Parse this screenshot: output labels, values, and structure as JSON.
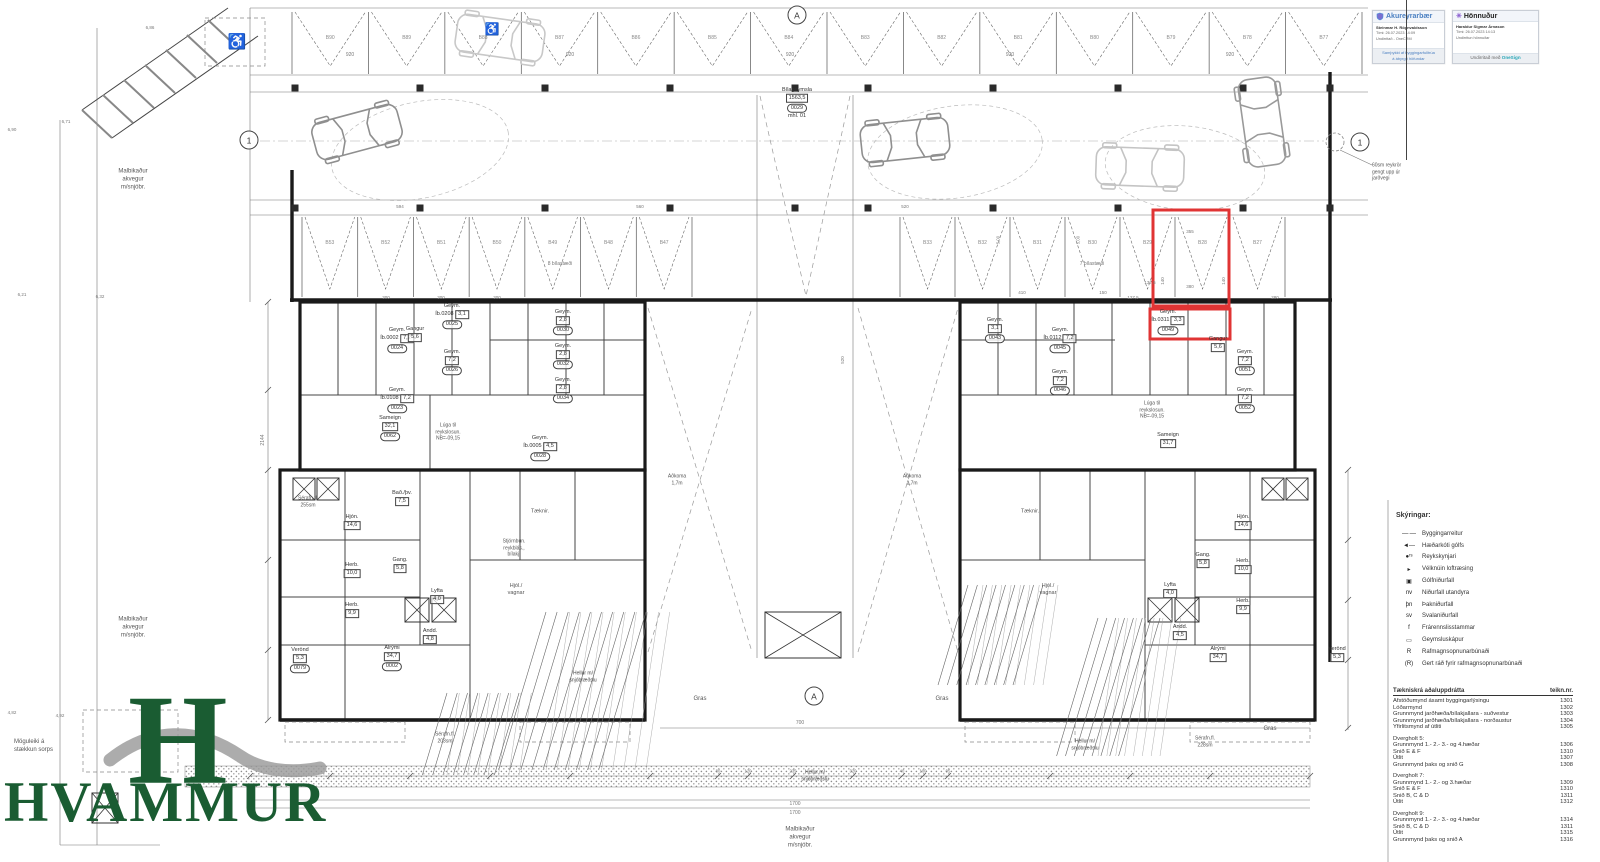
{
  "colors": {
    "highlight": "#e03434",
    "logo_green": "#1a5c32",
    "stamp_blue": "#4a7fc1",
    "onesign_teal": "#2aa7b8",
    "line_dark": "#333333"
  },
  "logo": {
    "mark": "H",
    "name": "HVAMMUR"
  },
  "stamps": {
    "municipality": {
      "header": "Akureyrarbær",
      "name": "Steinmar H. Rögnvaldsson",
      "time": "Tími: 26.07.2023 14:09",
      "sub": "Undirritað - OneCRM",
      "footer_line1": "Samþykkt af byggingarfulltrúa",
      "footer_line2": "á ábyrgð höfundar"
    },
    "designer": {
      "header": "Hönnuður",
      "icon": "✳",
      "name": "Haraldur Sigmar Árnason",
      "time": "Tími: 26.07.2023 14:13",
      "sub": "Undirritun hönnuðar",
      "footer_prefix": "Undirritað með ",
      "footer_brand": "OneSign"
    }
  },
  "legend": {
    "title": "Skýringar:",
    "items": [
      {
        "sym": "—·—",
        "label": "Byggingarreitur"
      },
      {
        "sym": "◄—",
        "label": "Hæðarkóti gólfs"
      },
      {
        "sym": "●ʳˢ",
        "label": "Reykskynjari"
      },
      {
        "sym": "▸",
        "label": "Vélknúin loftræsing"
      },
      {
        "sym": "▣",
        "label": "Gólfniðurfall"
      },
      {
        "sym": "nv",
        "label": "Niðurfall utandyra"
      },
      {
        "sym": "þn",
        "label": "Þakniðurfall"
      },
      {
        "sym": "sv",
        "label": "Svalaniðurfall"
      },
      {
        "sym": "f",
        "label": "Frárennslisstammar"
      },
      {
        "sym": "▭",
        "label": "Geymsluskápur"
      },
      {
        "sym": "R",
        "label": "Rafmagnsopnunarbúnaði"
      },
      {
        "sym": "(R)",
        "label": "Gert ráð fyrir rafmagnsopnunarbúnaði"
      }
    ]
  },
  "drawing_list": {
    "title": "Tækniskrá aðaluppdrátta",
    "col": "teikn.nr.",
    "sections": [
      {
        "rows": [
          [
            "Afstöðumynd ásamt byggingarlýsingu",
            "1301"
          ],
          [
            "Lóðarmynd",
            "1302"
          ],
          [
            "Grunnmynd jarðhæða/bílakjallara - suðvestur",
            "1303"
          ],
          [
            "Grunnmynd jarðhæða/bílakjallara - norðaustur",
            "1304"
          ],
          [
            "Yfirlitsmynd af útliti",
            "1305"
          ]
        ]
      },
      {
        "title": "Dvergholt 5:",
        "rows": [
          [
            "Grunnmynd 1.- 2.- 3.- og 4.hæðar",
            "1306"
          ],
          [
            "Snið E & F",
            "1310"
          ],
          [
            "Útlit",
            "1307"
          ],
          [
            "Grunnmynd þaks og snið G",
            "1308"
          ]
        ]
      },
      {
        "title": "Dvergholt 7:",
        "rows": [
          [
            "Grunnmynd 1.- 2.- og 3.hæðar",
            "1309"
          ],
          [
            "Snið E & F",
            "1310"
          ],
          [
            "Snið B, C & D",
            "1311"
          ],
          [
            "Útlit",
            "1312"
          ]
        ]
      },
      {
        "title": "Dvergholt 9:",
        "rows": [
          [
            "Grunnmynd 1.- 2.- 3.- og 4.hæðar",
            "1314"
          ],
          [
            "Snið B, C & D",
            "1311"
          ],
          [
            "Útlit",
            "1315"
          ],
          [
            "Grunnmynd þaks og snið A",
            "1316"
          ]
        ]
      }
    ]
  },
  "plan": {
    "markers": [
      {
        "t": "A",
        "x": 797,
        "y": 15
      },
      {
        "t": "A",
        "x": 814,
        "y": 696
      },
      {
        "t": "1",
        "x": 249,
        "y": 140
      },
      {
        "t": "1",
        "x": 1360,
        "y": 142
      }
    ],
    "parking": {
      "rows": [
        {
          "x0": 292,
          "x1": 1362,
          "y0": 12,
          "y1": 70,
          "labels": [
            "B90",
            "B89",
            "B88",
            "B87",
            "B86",
            "B85",
            "B84",
            "B83",
            "B82",
            "B81",
            "B80",
            "B79",
            "B78",
            "B77"
          ]
        },
        {
          "x0": 302,
          "x1": 692,
          "y0": 217,
          "y1": 293,
          "labels": [
            "B53",
            "B52",
            "B51",
            "B50",
            "B49",
            "B48",
            "B47"
          ]
        },
        {
          "x0": 900,
          "x1": 1285,
          "y0": 217,
          "y1": 293,
          "labels": [
            "B33",
            "B32",
            "B31",
            "B30",
            "B29",
            "B28",
            "B27"
          ]
        }
      ]
    },
    "rooms": [
      {
        "lines": [
          "Bílageymsla",
          "1563,5"
        ],
        "tag": "0029",
        "extra": "mhl. 01",
        "x": 797,
        "y": 103
      },
      {
        "lines": [
          "Geym.",
          "Íb.0002  7,2"
        ],
        "tag": "0024",
        "x": 397,
        "y": 340
      },
      {
        "lines": [
          "Geym.",
          "Íb.0108  7,2"
        ],
        "tag": "0023",
        "x": 397,
        "y": 400
      },
      {
        "lines": [
          "Geym.",
          "Íb.0208  3,1"
        ],
        "tag": "0025",
        "x": 452,
        "y": 316
      },
      {
        "lines": [
          "Geym.",
          "7,2"
        ],
        "tag": "0026",
        "x": 452,
        "y": 362
      },
      {
        "lines": [
          "Gangur",
          "5,6"
        ],
        "x": 415,
        "y": 334
      },
      {
        "lines": [
          "Sameign",
          "32,1"
        ],
        "tag": "0062",
        "x": 390,
        "y": 428
      },
      {
        "lines": [
          "Geym.",
          "2,8"
        ],
        "tag": "0030",
        "x": 563,
        "y": 322
      },
      {
        "lines": [
          "Geym.",
          "2,8"
        ],
        "tag": "0032",
        "x": 563,
        "y": 356
      },
      {
        "lines": [
          "Geym.",
          "2,8"
        ],
        "tag": "0034",
        "x": 563,
        "y": 390
      },
      {
        "lines": [
          "Geym.",
          "Íb.0005  4,5"
        ],
        "tag": "0028",
        "x": 540,
        "y": 448
      },
      {
        "lines": [
          "Geym.",
          "3,1"
        ],
        "tag": "0043",
        "x": 995,
        "y": 330
      },
      {
        "lines": [
          "Geym.",
          "Íb.0112  7,2"
        ],
        "tag": "0045",
        "x": 1060,
        "y": 340
      },
      {
        "lines": [
          "Geym.",
          "7,2"
        ],
        "tag": "0046",
        "x": 1060,
        "y": 382
      },
      {
        "lines": [
          "Geym.",
          "Íb.0311  3,3"
        ],
        "tag": "0049",
        "x": 1168,
        "y": 322
      },
      {
        "lines": [
          "Gangur",
          "5,6"
        ],
        "x": 1218,
        "y": 344
      },
      {
        "lines": [
          "Geym.",
          "7,2"
        ],
        "tag": "0051",
        "x": 1245,
        "y": 362
      },
      {
        "lines": [
          "Geym.",
          "7,2"
        ],
        "tag": "0052",
        "x": 1245,
        "y": 400
      },
      {
        "lines": [
          "Sameign",
          "31,7"
        ],
        "x": 1168,
        "y": 440
      },
      {
        "lines": [
          "Hjón.",
          "14,6"
        ],
        "x": 352,
        "y": 522
      },
      {
        "lines": [
          "Herb.",
          "10,0"
        ],
        "x": 352,
        "y": 570
      },
      {
        "lines": [
          "Herb.",
          "9,9"
        ],
        "x": 352,
        "y": 610
      },
      {
        "lines": [
          "Gang.",
          "5,8"
        ],
        "x": 400,
        "y": 565
      },
      {
        "lines": [
          "Lyfta",
          "4,0"
        ],
        "x": 437,
        "y": 596
      },
      {
        "lines": [
          "Andd.",
          "4,8"
        ],
        "x": 430,
        "y": 636
      },
      {
        "lines": [
          "Alrými",
          "34,7"
        ],
        "tag": "0002",
        "x": 392,
        "y": 658
      },
      {
        "lines": [
          "Bað./þv.",
          "7,5"
        ],
        "x": 402,
        "y": 498
      },
      {
        "lines": [
          "Verönd",
          "5,3"
        ],
        "tag": "0079",
        "x": 300,
        "y": 660
      },
      {
        "lines": [
          "Hjón.",
          "14,6"
        ],
        "x": 1243,
        "y": 522
      },
      {
        "lines": [
          "Herb.",
          "10,0"
        ],
        "x": 1243,
        "y": 566
      },
      {
        "lines": [
          "Herb.",
          "9,9"
        ],
        "x": 1243,
        "y": 606
      },
      {
        "lines": [
          "Gang.",
          "5,8"
        ],
        "x": 1203,
        "y": 560
      },
      {
        "lines": [
          "Lyfta",
          "4,0"
        ],
        "x": 1170,
        "y": 590
      },
      {
        "lines": [
          "Andd.",
          "4,5"
        ],
        "x": 1180,
        "y": 632
      },
      {
        "lines": [
          "Alrými",
          "34,7"
        ],
        "x": 1218,
        "y": 654
      },
      {
        "lines": [
          "Verönd",
          "5,3"
        ],
        "x": 1337,
        "y": 654
      }
    ],
    "labels": [
      {
        "t": "920",
        "x": 350,
        "y": 55,
        "fs": 5,
        "c": "#777"
      },
      {
        "t": "920",
        "x": 570,
        "y": 55,
        "fs": 5,
        "c": "#777"
      },
      {
        "t": "920",
        "x": 790,
        "y": 55,
        "fs": 5,
        "c": "#777"
      },
      {
        "t": "920",
        "x": 1010,
        "y": 55,
        "fs": 5,
        "c": "#777"
      },
      {
        "t": "920",
        "x": 1230,
        "y": 55,
        "fs": 5,
        "c": "#777"
      },
      {
        "t": "594",
        "x": 400,
        "y": 207,
        "fs": 4.5,
        "c": "#777"
      },
      {
        "t": "560",
        "x": 640,
        "y": 207,
        "fs": 4.5,
        "c": "#777"
      },
      {
        "t": "520",
        "x": 905,
        "y": 207,
        "fs": 4.5,
        "c": "#777"
      },
      {
        "t": "410",
        "x": 1022,
        "y": 293,
        "fs": 4.5,
        "c": "#777"
      },
      {
        "t": "150",
        "x": 1103,
        "y": 293,
        "fs": 4.5,
        "c": "#777"
      },
      {
        "t": "137,5",
        "x": 1150,
        "y": 283,
        "fs": 4.5,
        "c": "#777"
      },
      {
        "t": "127,5",
        "x": 1133,
        "y": 298,
        "fs": 4.5,
        "c": "#777"
      },
      {
        "t": "355",
        "x": 1190,
        "y": 232,
        "fs": 4.5,
        "c": "#777"
      },
      {
        "t": "380",
        "x": 1190,
        "y": 287,
        "fs": 4.5,
        "c": "#777"
      },
      {
        "t": "140",
        "x": 1163,
        "y": 281,
        "fs": 4.5,
        "r": -90,
        "c": "#777"
      },
      {
        "t": "140",
        "x": 1224,
        "y": 281,
        "fs": 4.5,
        "r": -90,
        "c": "#777"
      },
      {
        "t": "300",
        "x": 386,
        "y": 298,
        "fs": 4.5,
        "c": "#777"
      },
      {
        "t": "300",
        "x": 441,
        "y": 298,
        "fs": 4.5,
        "c": "#777"
      },
      {
        "t": "300",
        "x": 497,
        "y": 298,
        "fs": 4.5,
        "c": "#777"
      },
      {
        "t": "280",
        "x": 1275,
        "y": 298,
        "fs": 4.5,
        "c": "#777"
      },
      {
        "t": "700",
        "x": 800,
        "y": 723,
        "fs": 5,
        "c": "#777"
      },
      {
        "t": "1700",
        "x": 795,
        "y": 804,
        "fs": 5,
        "c": "#777"
      },
      {
        "t": "1700",
        "x": 795,
        "y": 813,
        "fs": 5,
        "c": "#777"
      },
      {
        "t": "80",
        "x": 718,
        "y": 771,
        "fs": 4.2,
        "c": "#777"
      },
      {
        "t": "120",
        "x": 748,
        "y": 771,
        "fs": 4.2,
        "c": "#777"
      },
      {
        "t": "235",
        "x": 793,
        "y": 771,
        "fs": 4.2,
        "c": "#777"
      },
      {
        "t": "320",
        "x": 853,
        "y": 771,
        "fs": 4.2,
        "c": "#777"
      },
      {
        "t": "40",
        "x": 902,
        "y": 771,
        "fs": 4.2,
        "c": "#777"
      },
      {
        "t": "100",
        "x": 923,
        "y": 771,
        "fs": 4.2,
        "c": "#777"
      },
      {
        "t": "95",
        "x": 948,
        "y": 771,
        "fs": 4.2,
        "c": "#777"
      },
      {
        "t": "2144",
        "x": 263,
        "y": 440,
        "fs": 5,
        "r": -90,
        "c": "#777"
      },
      {
        "t": "520",
        "x": 843,
        "y": 360,
        "fs": 4.5,
        "r": -90,
        "c": "#777"
      },
      {
        "t": "5,00",
        "x": 998,
        "y": 240,
        "fs": 4.2,
        "r": -90,
        "c": "#777"
      },
      {
        "t": "5,00",
        "x": 1078,
        "y": 240,
        "fs": 4.2,
        "r": -90,
        "c": "#777"
      },
      {
        "t": "6,86",
        "x": 150,
        "y": 28,
        "fs": 4.5,
        "c": "#777"
      },
      {
        "t": "6,71",
        "x": 66,
        "y": 122,
        "fs": 4.5,
        "c": "#777"
      },
      {
        "t": "6,90",
        "x": 12,
        "y": 130,
        "fs": 4.5,
        "c": "#777"
      },
      {
        "t": "6,21",
        "x": 22,
        "y": 295,
        "fs": 4.5,
        "c": "#777"
      },
      {
        "t": "6,32",
        "x": 100,
        "y": 297,
        "fs": 4.5,
        "c": "#777"
      },
      {
        "t": "4,92",
        "x": 60,
        "y": 716,
        "fs": 4.5,
        "c": "#777"
      },
      {
        "t": "4,82",
        "x": 12,
        "y": 713,
        "fs": 4.5,
        "c": "#777"
      },
      {
        "t": "Malbikaður\nakvegur\nm/snjóbr.",
        "x": 133,
        "y": 180,
        "fs": 6
      },
      {
        "t": "Malbikaður\nakvegur\nm/snjóbr.",
        "x": 133,
        "y": 628,
        "fs": 6
      },
      {
        "t": "Malbikaður\nakvegur\nm/snjóbr.",
        "x": 800,
        "y": 838,
        "fs": 6
      },
      {
        "t": "Möguleiki á\nstækkun sorps",
        "x": 14,
        "y": 747,
        "fs": 6,
        "al": "left"
      },
      {
        "t": "60sm reykrör\ngengt upp úr\njarðvegi",
        "x": 1372,
        "y": 172,
        "fs": 5,
        "al": "left"
      },
      {
        "t": "Gras",
        "x": 700,
        "y": 700,
        "fs": 6
      },
      {
        "t": "Gras",
        "x": 942,
        "y": 700,
        "fs": 6
      },
      {
        "t": "Gras",
        "x": 1270,
        "y": 730,
        "fs": 6
      },
      {
        "t": "Hellur m/\nsnjóbræðslu",
        "x": 583,
        "y": 677,
        "fs": 5,
        "c": "#444"
      },
      {
        "t": "Hellur m/\nsnjóbræðslu",
        "x": 815,
        "y": 776,
        "fs": 5,
        "c": "#444"
      },
      {
        "t": "Hellur m/\nsnjóbræðslu",
        "x": 1085,
        "y": 745,
        "fs": 5,
        "c": "#444"
      },
      {
        "t": "Sérafn.fl.\n255sm",
        "x": 308,
        "y": 502,
        "fs": 5
      },
      {
        "t": "Sérafn.fl.\n203sm",
        "x": 445,
        "y": 738,
        "fs": 5
      },
      {
        "t": "Sérafn.fl.\n228sm",
        "x": 1205,
        "y": 742,
        "fs": 5
      },
      {
        "t": "Aðkoma\n1,7m",
        "x": 677,
        "y": 480,
        "fs": 5
      },
      {
        "t": "Aðkoma\n1,7m",
        "x": 912,
        "y": 480,
        "fs": 5
      },
      {
        "t": "8 bílastæði",
        "x": 560,
        "y": 264,
        "fs": 5,
        "c": "#777"
      },
      {
        "t": "7 bílastæði",
        "x": 1092,
        "y": 264,
        "fs": 5,
        "c": "#777"
      },
      {
        "t": "Stjórnbún.\nreykblás.,\nbílakj.",
        "x": 514,
        "y": 548,
        "fs": 5
      },
      {
        "t": "Tæknir.",
        "x": 540,
        "y": 512,
        "fs": 5.5
      },
      {
        "t": "Tæknir.",
        "x": 1030,
        "y": 512,
        "fs": 5.5
      },
      {
        "t": "Hjól./\nvagnar",
        "x": 516,
        "y": 590,
        "fs": 5.5
      },
      {
        "t": "Hjól./\nvagnar",
        "x": 1048,
        "y": 590,
        "fs": 5.5
      },
      {
        "t": "Lúga til\nreykslosun.\nNB=-09,15",
        "x": 448,
        "y": 432,
        "fs": 5
      },
      {
        "t": "Lúga til\nreykslosun.\nNB=-09,15",
        "x": 1152,
        "y": 410,
        "fs": 5
      },
      {
        "t": "♿",
        "x": 237,
        "y": 42,
        "fs": 15,
        "c": "#777"
      },
      {
        "t": "♿",
        "x": 492,
        "y": 30,
        "fs": 12,
        "c": "#b0b0b0"
      }
    ]
  }
}
